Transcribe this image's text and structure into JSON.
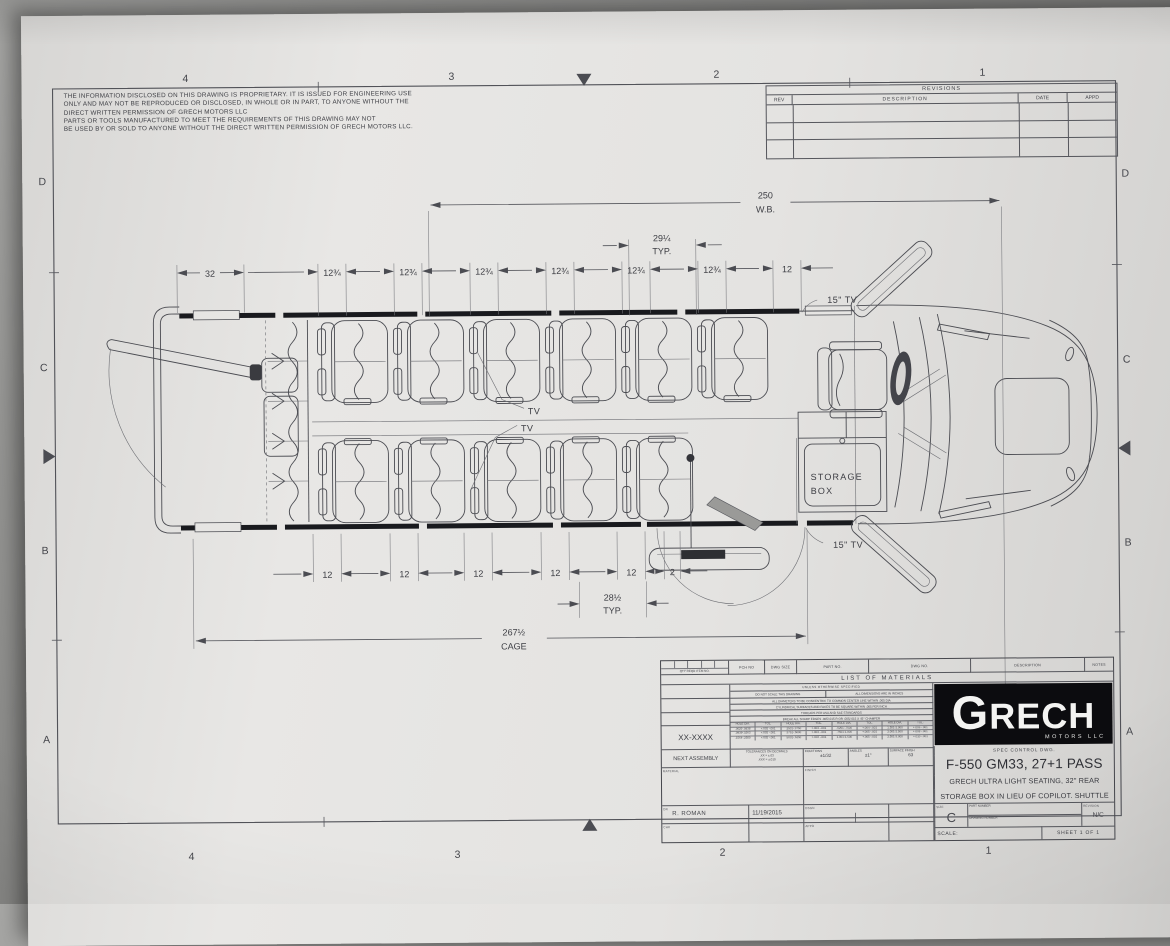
{
  "notice": {
    "l1": "THE  INFORMATION  DISCLOSED  ON  THIS  DRAWING  IS  PROPRIETARY.   IT  IS  ISSUED  FOR  ENGINEERING  USE",
    "l2": "ONLY  AND  MAY  NOT  BE  REPRODUCED  OR  DISCLOSED,  IN  WHOLE  OR  IN  PART,  TO  ANYONE  WITHOUT  THE",
    "l3": "DIRECT  WRITTEN  PERMISSION  OF  GRECH  MOTORS  LLC",
    "l4": "PARTS  OR  TOOLS  MANUFACTURED  TO  MEET  THE  REQUIREMENTS  OF  THIS  DRAWING  MAY  NOT",
    "l5": "BE  USED  BY  OR  SOLD  TO  ANYONE  WITHOUT  THE  DIRECT  WRITTEN  PERMISSION  OF  GRECH  MOTORS  LLC."
  },
  "zones": {
    "cols": [
      "4",
      "3",
      "2",
      "1"
    ],
    "rows": [
      "D",
      "C",
      "B",
      "A"
    ]
  },
  "revisions": {
    "title": "REVISIONS",
    "rev": "REV",
    "description": "DESCRIPTION",
    "date": "DATE",
    "appd": "APPD"
  },
  "dims": {
    "wb": "250",
    "wb_sub": "W.B.",
    "pitch": "29¼",
    "typ": "TYP.",
    "rear": "32",
    "gap": "12¾",
    "front12": "12",
    "seat12": "12",
    "two": "2",
    "row": "28½",
    "row_sub": "TYP.",
    "cage": "267½",
    "cage_sub": "CAGE"
  },
  "callouts": {
    "tv": "TV",
    "tv15": "15\" TV",
    "storage1": "STORAGE",
    "storage2": "BOX"
  },
  "logo": {
    "name": "GRECH",
    "sub": "MOTORS LLC"
  },
  "title_block": {
    "header": {
      "qty": "QTY REQD",
      "item": "ITEM NO.",
      "pch": "PCH NO",
      "size": "DWG SIZE",
      "part": "PART NO.",
      "dwg": "DWG NO.",
      "description": "DESCRIPTION",
      "notes": "NOTES"
    },
    "list_of_materials": "LIST  OF  MATERIALS",
    "unless": "UNLESS OTHERWISE SPECIFIED",
    "note1a": "DO NOT SCALE THIS DRAWING",
    "note1b": "ALL DIMENSIONS ARE IN INCHES",
    "note2": "ALL DIAMETERS TO BE CONCENTRIC TO COMMON CENTER LINE WITHIN .005 DIA",
    "note3": "CYLINDRICAL SURFACES AND FACES TO BE SQUARE WITHIN .005 PER INCH",
    "note4": "THREADS PER ASA AND SAE STANDARDS",
    "note5": "BREAK ALL SHARP EDGES .005/.015 R OR .005/.015 X 45° CHAMFER",
    "hole_table": {
      "headers": [
        "HOLE DIA.",
        "TOL.",
        "HOLE DIA.",
        "TOL.",
        "HOLE DIA.",
        "TOL.",
        "HOLE DIA.",
        "TOL."
      ],
      "rows": [
        [
          ".0625-.0938",
          "+.002 -.001",
          ".2501-.3750",
          "+.003 -.001",
          ".6251-.7500",
          "+.004 -.001",
          "1.501-2.000",
          "+.006 -.001"
        ],
        [
          ".0939-.1563",
          "+.002 -.001",
          ".3751-.5000",
          "+.003 -.001",
          ".7501-1.000",
          "+.005 -.001",
          "2.001-2.500",
          "+.008 -.001"
        ],
        [
          ".1564-.2500",
          "+.002 -.001",
          ".5001-.6250",
          "+.004 -.001",
          "1.001-1.500",
          "+.005 -.001",
          "2.501-3.000",
          "+.010 -.001"
        ]
      ]
    },
    "tol_label": "TOLERANCES ON DECIMALS",
    "tol_xx": ".XX = ±.03",
    "tol_xxx": ".XXX = ±.010",
    "fractions_label": "FRACTIONS",
    "fractions": "±1/32",
    "angles_label": "ANGLES",
    "angles": "±1°",
    "surface_label": "SURFACE FINISH",
    "surface": "63",
    "xx_number": "XX-XXXX",
    "next_assembly": "NEXT ASSEMBLY",
    "material_label": "MATERIAL",
    "finish_label": "FINISH",
    "dr_label": "DR",
    "drawn_by": "R. ROMAN",
    "date": "11/19/2015",
    "chk_label": "CHK",
    "dsgn_label": "DSGN",
    "appd_label": "APPD",
    "spec": "SPEC CONTROL DWG.",
    "title": "F-550 GM33, 27+1 PASS",
    "desc1": "GRECH ULTRA LIGHT SEATING, 32\" REAR LUGGAGE",
    "desc2": "STORAGE BOX IN LIEU OF COPILOT. SHUTTLE BUS",
    "size_label": "SIZE",
    "size": "C",
    "part_number_label": "PART NUMBER",
    "drawing_number_label": "DRAWING NUMBER",
    "revision_label": "REVISION",
    "revision": "N/C",
    "scale_label": "SCALE:",
    "sheet": "SHEET  1  OF  1"
  }
}
